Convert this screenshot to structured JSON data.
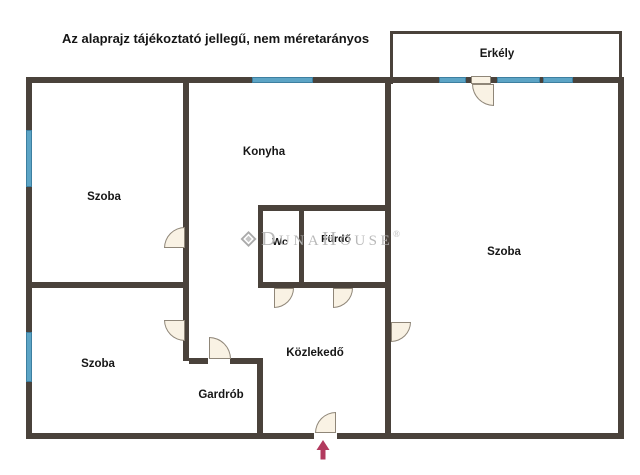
{
  "title": "Az alaprajz tájékoztató jellegű, nem méretarányos",
  "rooms": {
    "balcony": "Erkély",
    "kitchen": "Konyha",
    "room_top_left": "Szoba",
    "room_bottom_left": "Szoba",
    "room_right": "Szoba",
    "wc": "Wc",
    "bathroom": "Fürdő",
    "hallway": "Közlekedő",
    "wardrobe": "Gardrób"
  },
  "watermark": {
    "d": "D",
    "una": "UNA",
    "h": "H",
    "ouse": "OUSE",
    "reg": "®"
  },
  "icons": {
    "entrance_arrow": "up-arrow-entrance-marker",
    "logo": "duna-house-diamond-logo"
  },
  "colors": {
    "wall": "#4a423b",
    "window": "#5ca4c5",
    "window_edge": "#3d7fa0",
    "door_fill": "#f9f2e4",
    "door_outline": "#8f8678",
    "arrow": "#b23a5e",
    "watermark": "#b6b6b6",
    "text": "#161616",
    "background": "#ffffff"
  }
}
